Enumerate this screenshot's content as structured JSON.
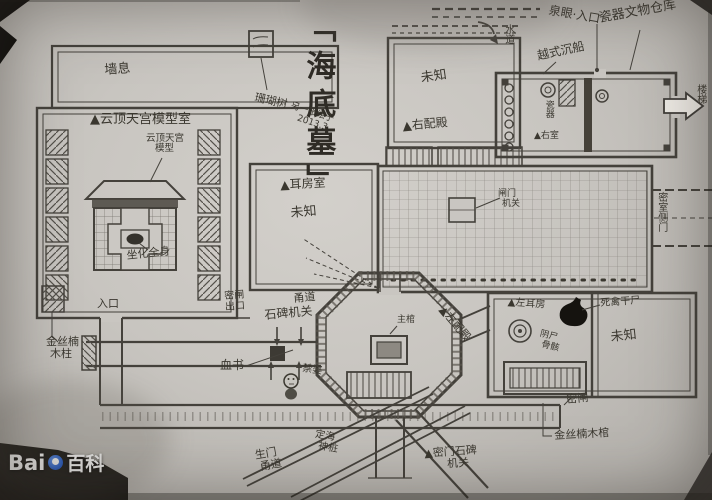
{
  "title": "「海底墓」",
  "annotations": {
    "note_line1": "另一张绘于",
    "note_line2": "2013.3",
    "coral_tree": "珊瑚树",
    "corridor_top": "墙息",
    "model_room_heading": "▲云顶天宫模型室",
    "model_caption_line1": "云顶天宫",
    "model_caption_line2": "模型",
    "seated_body": "坐化全身",
    "entrance": "入口",
    "nanmu_pillar_line1": "金丝楠",
    "nanmu_pillar_line2": "木柱",
    "ear_chamber": "▲耳房室",
    "unknown_mid_left": "未知",
    "unknown_upper": "未知",
    "right_side_hall": "▲右配殿",
    "spring_eye_entrance": "泉眼·入口",
    "waterway": "水道",
    "shipwreck": "越式沉船",
    "porcelain_warehouse": "瓷器文物仓库",
    "porcelain": "瓷器",
    "right_small_chamber": "▲右室",
    "stairs": "楼梯",
    "side_door": "密室侧门",
    "gate_mech_line1": "闸门",
    "gate_mech_line2": "机关",
    "main_corridor": "甬道",
    "stone_tablet_mechanism": "石碑机关",
    "secret_gate_exit_line1": "密闸",
    "secret_gate_exit_line2": "出口",
    "blood_writing": "血书",
    "jinpo": "禁婆",
    "main_coffin": "主棺",
    "left_side_hall": "▲左配殿",
    "left_ear_chamber": "▲左耳房",
    "yin_corpse_line1": "阴尸",
    "yin_corpse_line2": "骨骸",
    "dead_bird_mummy": "死禽干尸",
    "unknown_right": "未知",
    "sluice_gate": "密闸",
    "nanmu_coffin": "金丝楠木棺",
    "secret_door_mech_line1": "▲密门石碑",
    "secret_door_mech_line2": "机关",
    "life_gate_line1": "生门",
    "life_gate_line2": "甬道",
    "sea_anchor_line1": "定海",
    "sea_anchor_line2": "神桩"
  },
  "watermark": {
    "prefix": "Bai",
    "suffix": "百科"
  }
}
